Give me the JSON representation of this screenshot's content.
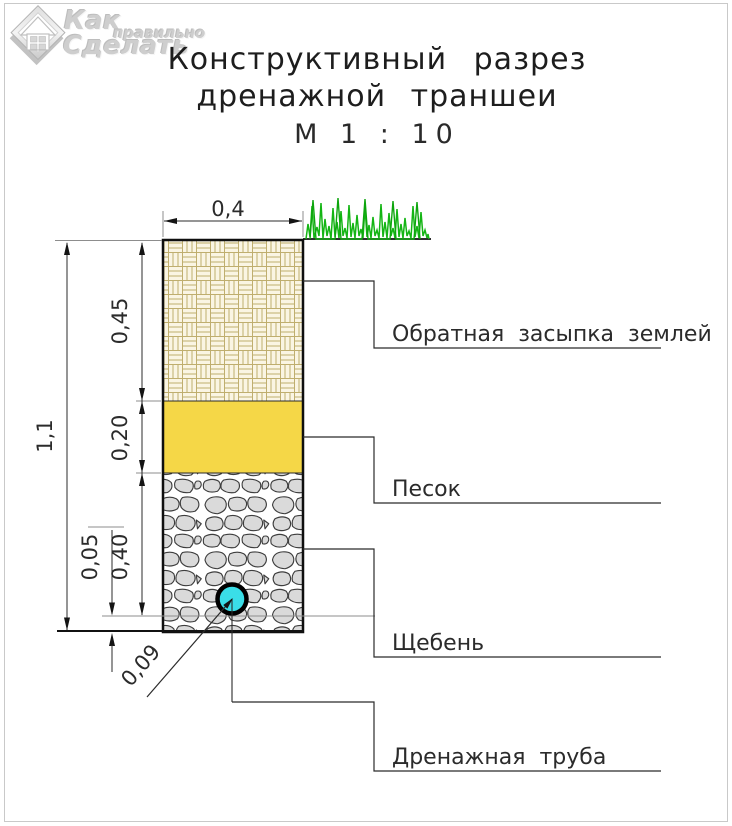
{
  "logo": {
    "word1": "Как",
    "word2": "правильно",
    "word3": "Сделать"
  },
  "title": {
    "line1": "Конструктивный разрез",
    "line2": "дренажной траншеи",
    "scale": "М 1 : 10"
  },
  "dimensions": {
    "trench_width": "0,4",
    "total_depth": "1,1",
    "backfill_depth": "0,45",
    "sand_depth": "0,20",
    "gravel_depth": "0,40",
    "bedding_depth": "0,05",
    "pipe_diameter": "0,09"
  },
  "labels": {
    "backfill": "Обратная засыпка землей",
    "sand": "Песок",
    "gravel": "Щебень",
    "pipe": "Дренажная труба"
  },
  "colors": {
    "sand": "#F5D747",
    "pipe": "#3ADEE8",
    "grass": "#14B514",
    "grass_dark": "#0DA50D",
    "weave_line": "#BFAE6E",
    "stone_fill": "#DADADA",
    "dim_line": "#2B2B2B"
  }
}
